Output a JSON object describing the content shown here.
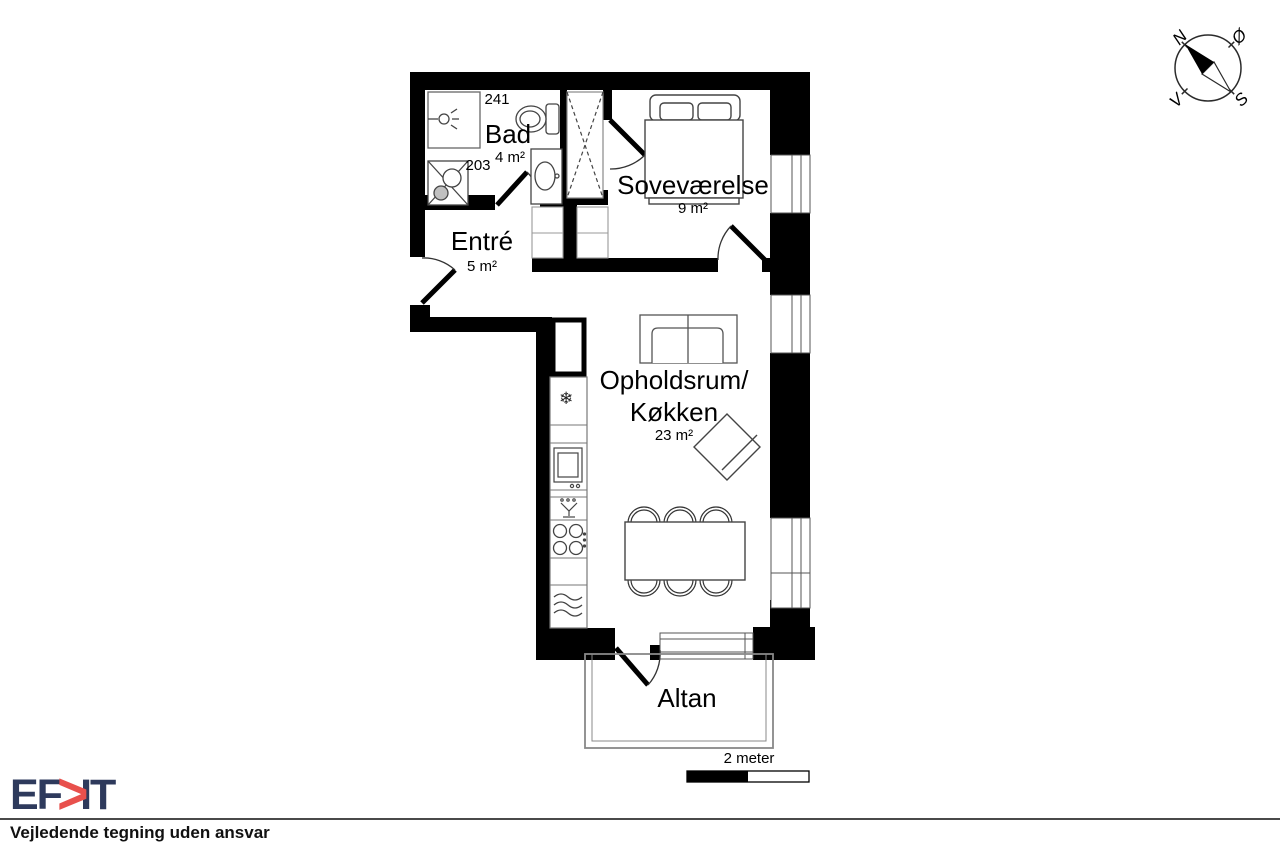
{
  "title_block": {
    "logo": {
      "prefix": "EF",
      "chevron": ">",
      "suffix": "IT"
    },
    "disclaimer": "Vejledende tegning uden ansvar"
  },
  "compass": {
    "north": "N",
    "east": "Ø",
    "south": "S",
    "west": "V"
  },
  "scale_bar": {
    "label": "2 meter"
  },
  "rooms": {
    "bad": {
      "name": "Bad",
      "area": "4 m²"
    },
    "entre": {
      "name": "Entré",
      "area": "5 m²"
    },
    "sovevaerelse": {
      "name": "Soveværelse",
      "area": "9 m²"
    },
    "opholdsrum_kokken": {
      "name_line1": "Opholdsrum/",
      "name_line2": "Køkken",
      "area": "23 m²"
    },
    "altan": {
      "name": "Altan"
    }
  },
  "room_numbers": {
    "r241": "241",
    "r203": "203"
  },
  "icons": {
    "freezer": "❄"
  },
  "colors": {
    "wall": "#000000",
    "logo_navy": "#2e3a5c",
    "logo_red": "#e8504c"
  }
}
